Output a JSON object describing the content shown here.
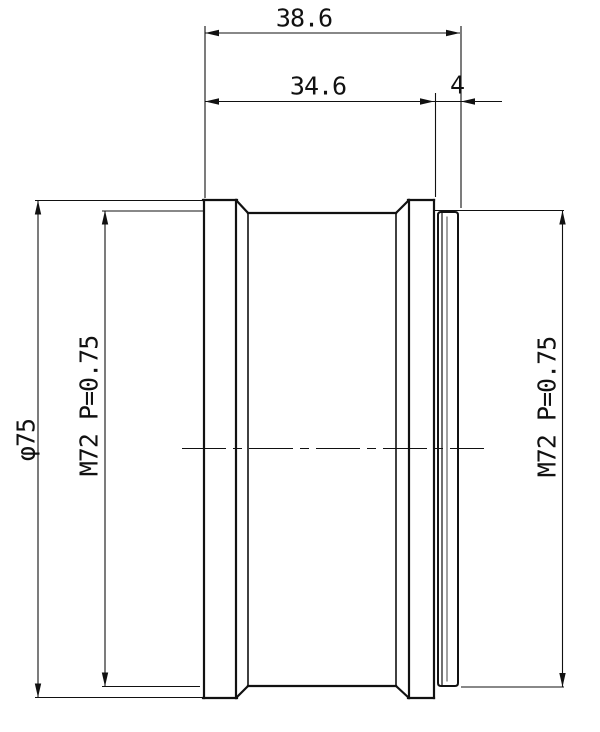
{
  "drawing": {
    "type_hint": "mechanical part side view with dimensions",
    "background_color": "#ffffff",
    "line_color": "#111111",
    "dims": {
      "total_length": "38.6",
      "body_length": "34.6",
      "ring_length": "4",
      "outer_diameter": "φ75",
      "thread_left": "M72 P=0.75",
      "thread_right": "M72 P=0.75"
    }
  }
}
